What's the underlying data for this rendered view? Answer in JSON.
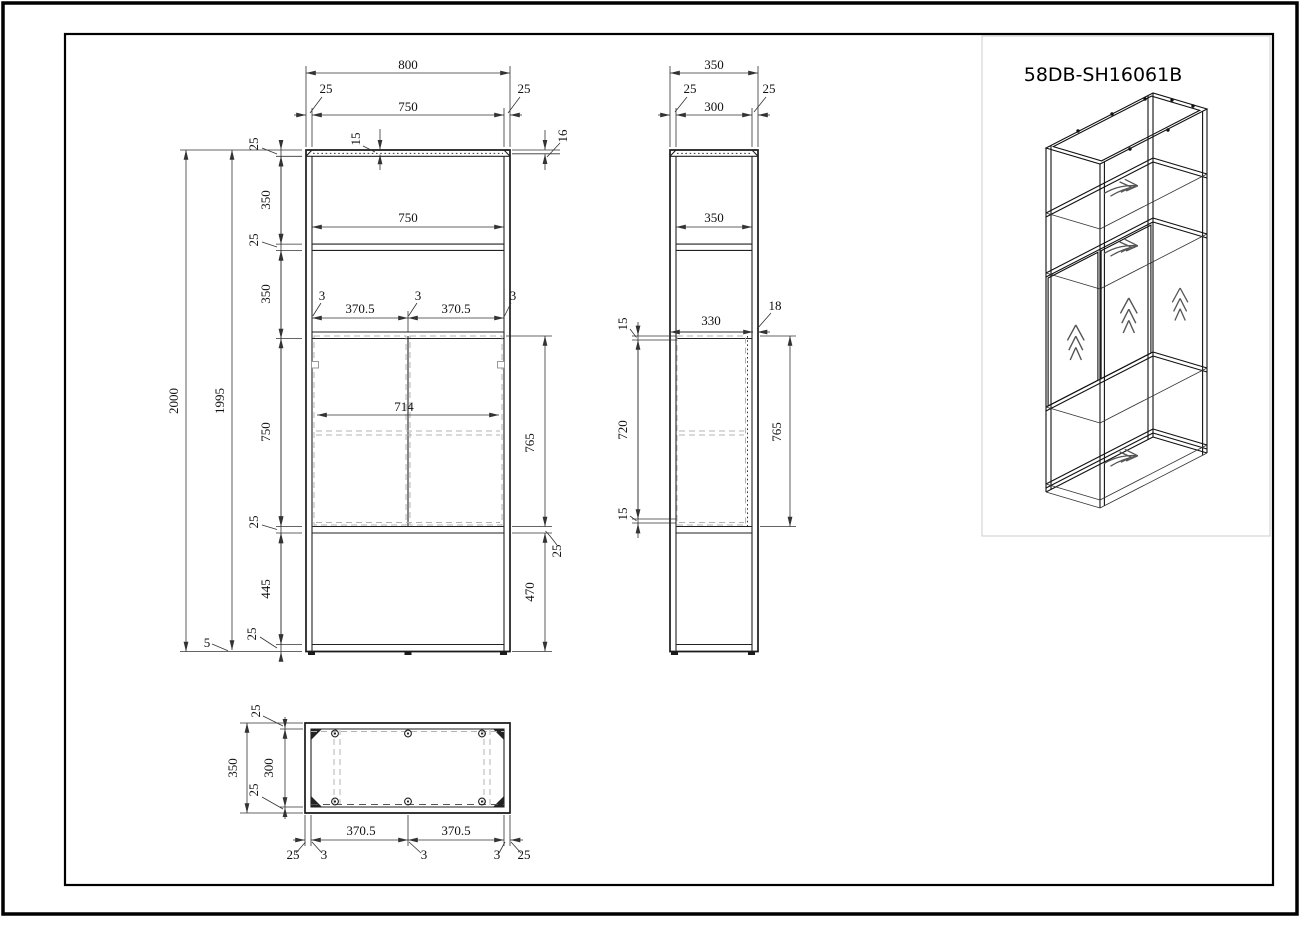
{
  "title": "58DB-SH16061B",
  "front_view": {
    "overall_width": "800",
    "frame_left": "25",
    "inner_width_top": "750",
    "frame_right": "25",
    "panel_inset": "15",
    "top_rail": "16",
    "inner_width": "750",
    "overall_height": "2000",
    "frame_height": "1995",
    "seg_top_frame": "25",
    "seg_opening1": "350",
    "seg_shelf1": "25",
    "seg_opening2": "350",
    "seg_doors": "750",
    "seg_shelf2": "25",
    "seg_opening3": "445",
    "seg_bottom_frame": "25",
    "foot_height": "5",
    "door_gap_left": "3",
    "door_width_left": "370.5",
    "door_gap_mid": "3",
    "door_width_right": "370.5",
    "door_gap_right": "3",
    "doors_inner_width": "714",
    "door_height": "765",
    "shelf_thickness": "25",
    "bottom_opening": "470"
  },
  "side_view": {
    "overall_depth": "350",
    "frame_front": "25",
    "inner_depth": "300",
    "frame_back": "25",
    "inner_depth_mid": "350",
    "door_depth": "330",
    "door_thickness": "18",
    "clearance_top": "15",
    "door_span": "720",
    "clearance_bottom": "15",
    "door_height": "765"
  },
  "top_view": {
    "frame_top": "25",
    "overall_depth": "350",
    "inner_depth": "300",
    "frame_bottom": "25",
    "edge_left": "25",
    "gap_left": "3",
    "door_width_left": "370.5",
    "gap_mid": "3",
    "door_width_right": "370.5",
    "gap_right": "3",
    "edge_right": "25"
  }
}
